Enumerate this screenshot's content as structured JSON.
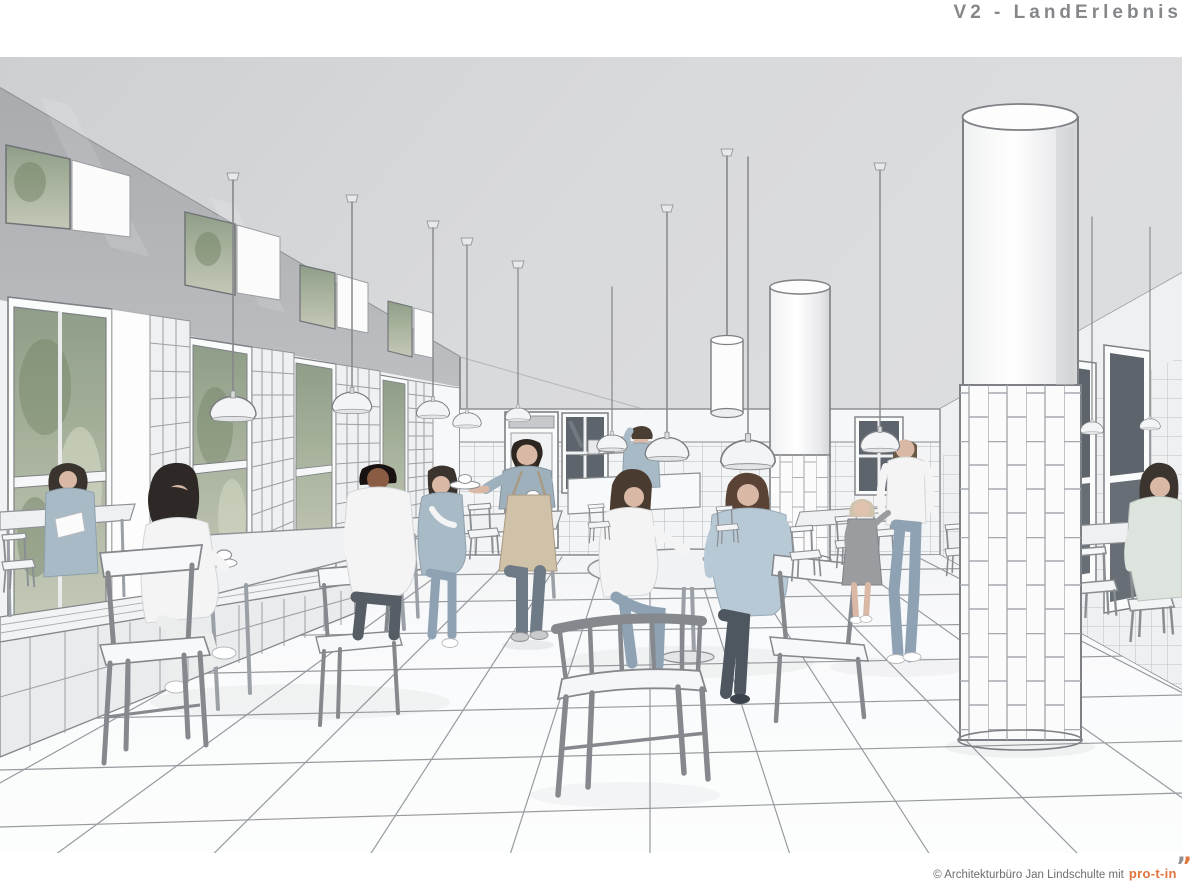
{
  "header": {
    "title": "V2 - LandErlebnis",
    "title_color": "#85878a"
  },
  "scene": {
    "name": "cafeteria-interior-rendering",
    "description": "Monochrome architectural visualization of a tiled cafeteria hall: tall windows with greenery on the left, white tiled piers and columns, pendant lamps, white wooden tables and chairs, guests seated and walking, a waiter serving coffee in the center.",
    "palette": {
      "ceiling": "#d6d7d9",
      "upper_wall": "#b5b7ba",
      "tile_white": "#f3f4f5",
      "line_ink": "#7d8084",
      "floor": "#fafbfc",
      "foliage": "#96a48f",
      "denim": "#a9bac7",
      "apron_tan": "#cfc2a9"
    }
  },
  "footer": {
    "copyright": "© Architekturbüro Jan Lindschulte mit",
    "logo_text": "pro-t-in",
    "logo_color": "#e2743c",
    "text_color": "#6d6d6d",
    "quote_glyph": "’"
  }
}
